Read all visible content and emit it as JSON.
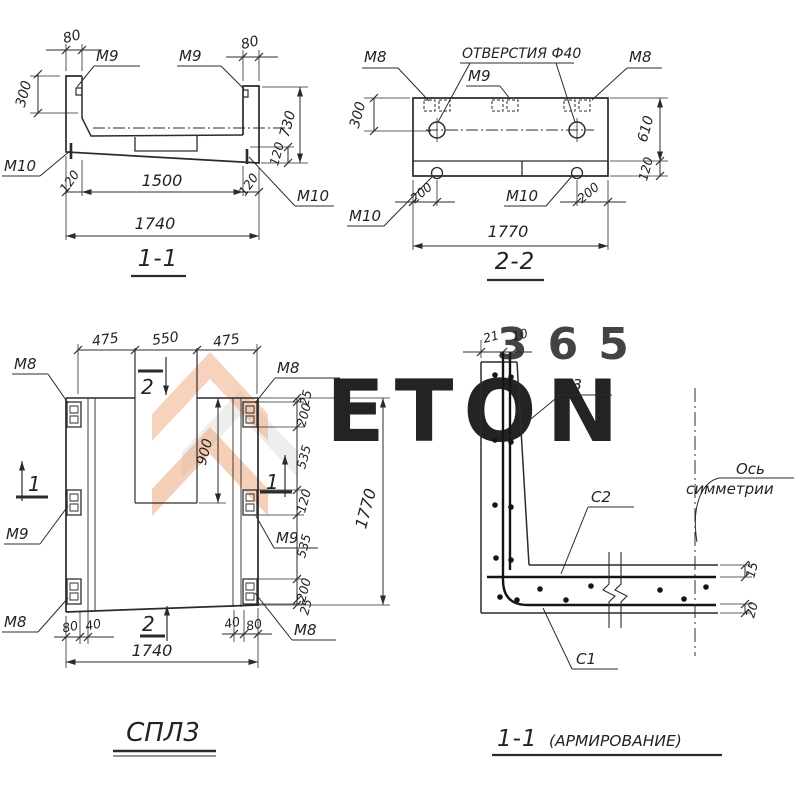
{
  "watermark": {
    "letters": "ETON",
    "digits": "365"
  },
  "colors": {
    "ink": "#2b2b2b",
    "paper": "#ffffff",
    "wm_orange": "#efa87d",
    "wm_grey": "#e9e9e9"
  },
  "section_1_1": {
    "title": "1-1",
    "labels": {
      "m9_left": "М9",
      "m9_right": "М9",
      "m10_left": "М10",
      "m10_right": "М10"
    },
    "dims": {
      "top_left": "80",
      "top_right": "80",
      "left": "300",
      "right_total": "730",
      "right_slab": "120",
      "bottom_left": "120",
      "bottom_mid": "1500",
      "bottom_right": "120",
      "overall": "1740"
    }
  },
  "section_2_2": {
    "title": "2-2",
    "labels": {
      "m8_left": "М8",
      "holes": "ОТВЕРСТИЯ Ф40",
      "m9": "М9",
      "m8_right": "М8",
      "m10_left": "М10",
      "m10_mid": "М10"
    },
    "dims": {
      "left": "300",
      "right_top": "610",
      "right_slab": "120",
      "bottom_left": "200",
      "bottom_right": "200",
      "overall": "1770"
    }
  },
  "plan": {
    "title": "СПЛ3",
    "labels": {
      "m8_top_left": "М8",
      "m9_left": "М9",
      "m8_bottom_left": "М8",
      "m8_top_right": "М8",
      "m9_right": "М9",
      "m8_bottom_right": "М8"
    },
    "marks": {
      "sec1_left": "1",
      "sec1_mid": "1",
      "sec2_top": "2",
      "sec2_bottom": "2"
    },
    "dims": {
      "top": [
        "475",
        "550",
        "475"
      ],
      "cavity": "900",
      "right_col": [
        "25",
        "200",
        "535",
        "120",
        "535",
        "200",
        "25"
      ],
      "right_overall": "1770",
      "bottom_left": [
        "80",
        "40"
      ],
      "bottom_right": [
        "40",
        "80"
      ],
      "overall": "1740"
    }
  },
  "rebar": {
    "title": "1-1",
    "subtitle": "(АРМИРОВАНИЕ)",
    "labels": {
      "c3": "С3",
      "c2": "С2",
      "c1": "С1",
      "axis_line1": "Ось",
      "axis_line2": "симметрии"
    },
    "dims": {
      "top_cover": "21",
      "top_gap": "10",
      "right_top": "15",
      "right_bottom": "20"
    }
  }
}
